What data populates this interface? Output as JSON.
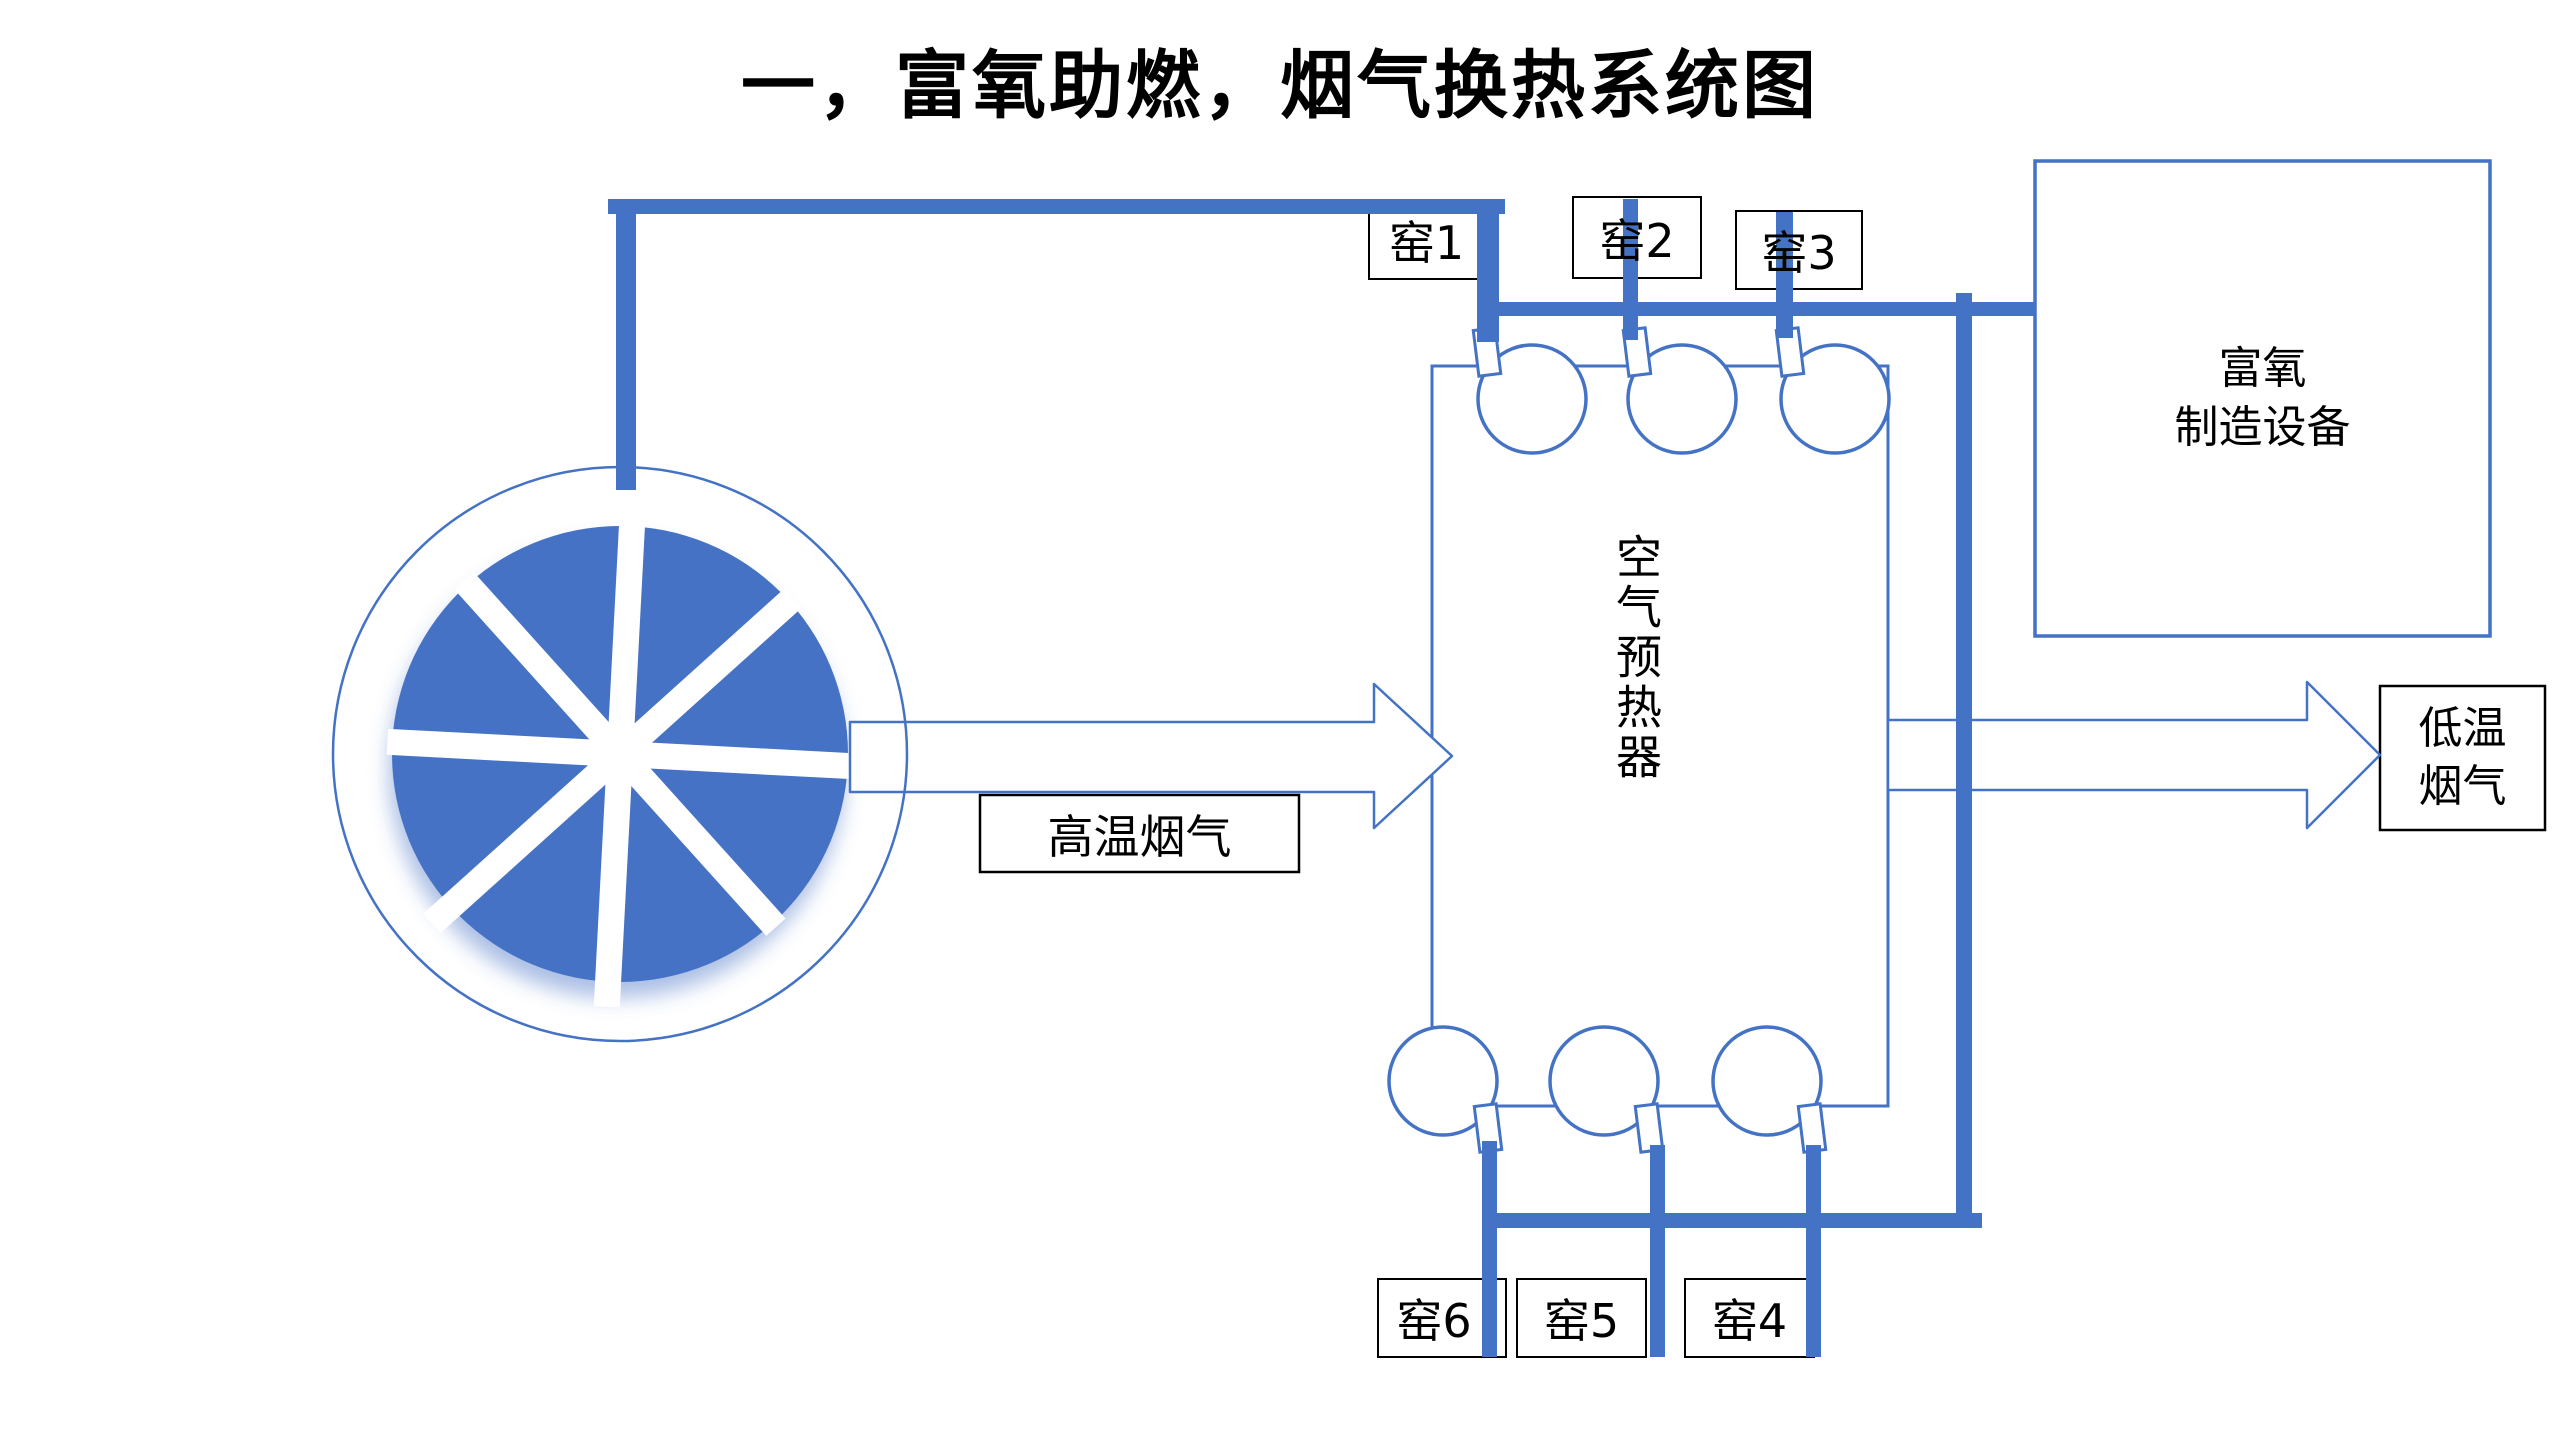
{
  "title": "一，富氧助燃，烟气换热系统图",
  "kilns_top": [
    "窑1",
    "窑2",
    "窑3"
  ],
  "kilns_bottom": [
    "窑6",
    "窑5",
    "窑4"
  ],
  "preheater": {
    "label": "空气预热器"
  },
  "oxygen_plant": {
    "line1": "富氧",
    "line2": "制造设备"
  },
  "hot_flue_gas": {
    "label": "高温烟气"
  },
  "cold_flue_gas": {
    "line1": "低温",
    "line2": "烟气"
  },
  "colors": {
    "accent_blue": "#4472C4",
    "text_black": "#000000",
    "background": "#FFFFFF",
    "box_border_black": "#000000"
  },
  "icons": {
    "wheel": "rotary-regenerator-wheel-icon",
    "blower": "centrifugal-fan-icon",
    "hot_arrow": "right-arrow-icon",
    "cold_arrow": "right-arrow-icon"
  }
}
